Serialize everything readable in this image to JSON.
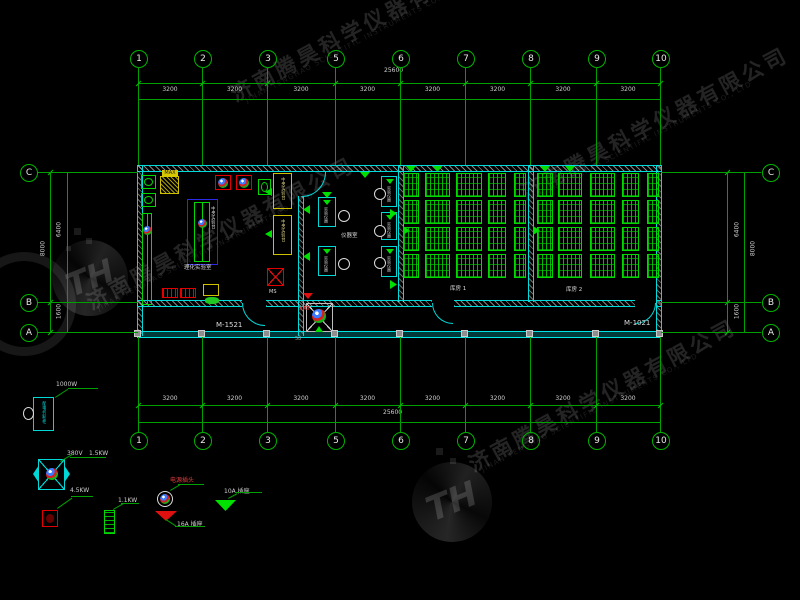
{
  "company": {
    "name_cn": "济南腾昊科学仪器有限公司",
    "name_en": "JINAN TENGHAO SCIENTIFIC INSTRUMENTS CO., LTD",
    "logo": "TH"
  },
  "axes": {
    "top": [
      "1",
      "2",
      "3",
      "5",
      "6",
      "7",
      "8",
      "9",
      "10"
    ],
    "bottom": [
      "1",
      "2",
      "3",
      "5",
      "6",
      "7",
      "8",
      "9",
      "10"
    ],
    "left": [
      "C",
      "B",
      "A"
    ],
    "right": [
      "C",
      "B",
      "A"
    ],
    "x_positions": [
      138,
      202,
      267,
      335,
      400,
      465,
      530,
      596,
      660
    ],
    "row_y": [
      172,
      302,
      332
    ],
    "bay_dim": "3200",
    "total_dim": "25600",
    "dim_cb": "6400",
    "dim_ba": "1600",
    "dim_total_v": "8000"
  },
  "plan": {
    "room_left_label": "理化实验室",
    "room_mid_label": "仪器室",
    "room_store1_label": "库房 1",
    "room_store2_label": "库房 2",
    "door_left": "M-1521",
    "door_right": "M-1021",
    "bench_label": "中央实验台",
    "instrument_label": "实验仪器",
    "hood_tag": "MAX",
    "entrance_label": "XAT",
    "drain_label": "MS",
    "wall_note": "58",
    "racks_room1": [
      [
        403,
        16
      ],
      [
        425,
        25
      ],
      [
        456,
        26
      ],
      [
        488,
        18
      ],
      [
        514,
        12
      ]
    ],
    "racks_room2": [
      [
        537,
        16
      ],
      [
        558,
        24
      ],
      [
        590,
        25
      ],
      [
        622,
        17
      ],
      [
        647,
        12
      ]
    ]
  },
  "legend": {
    "cabinet_label": "配电控制柜",
    "cabinet_power": "1000W",
    "mixer_voltage": "380V",
    "mixer_power": "1.5KW",
    "heater_power": "4.5KW",
    "pump_power": "1.1KW",
    "plug_label": "电源插头",
    "socket16": "16A 插座",
    "socket10": "10A 插座"
  }
}
